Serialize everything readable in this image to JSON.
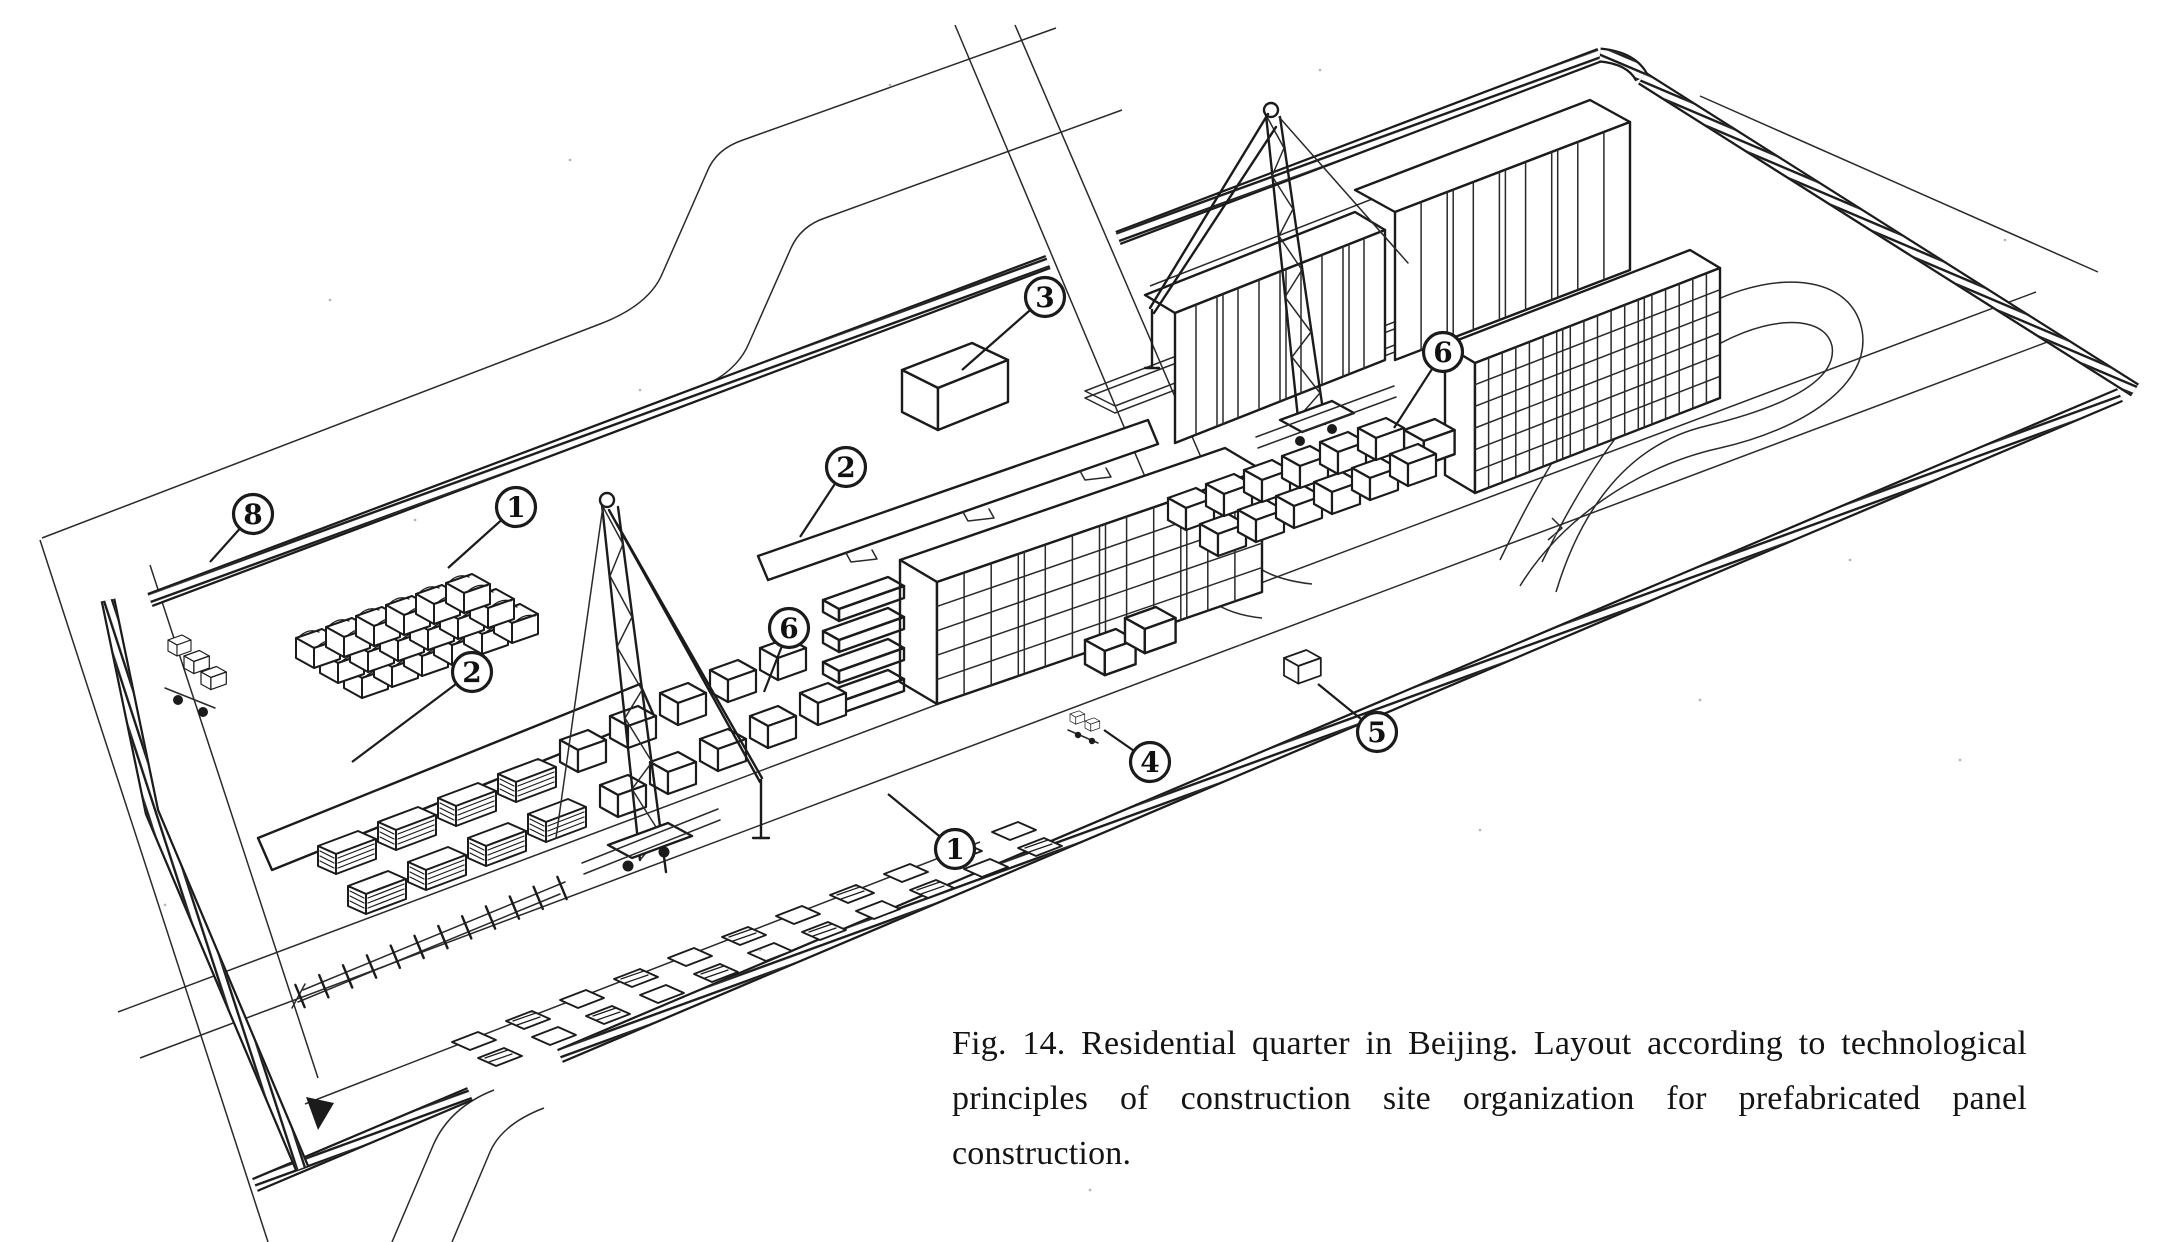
{
  "figure": {
    "caption": "Fig. 14. Residential quarter in Beijing. Layout according to technological principles of construction site organization for prefabricated panel construction.",
    "callouts": [
      {
        "label": "8",
        "cx": 253,
        "cy": 514,
        "lx": 210,
        "ly": 562
      },
      {
        "label": "1",
        "cx": 516,
        "cy": 507,
        "lx": 448,
        "ly": 568
      },
      {
        "label": "2",
        "cx": 472,
        "cy": 672,
        "lx": 352,
        "ly": 762
      },
      {
        "label": "6",
        "cx": 789,
        "cy": 628,
        "lx": 764,
        "ly": 692
      },
      {
        "label": "2",
        "cx": 846,
        "cy": 467,
        "lx": 800,
        "ly": 537
      },
      {
        "label": "3",
        "cx": 1045,
        "cy": 297,
        "lx": 962,
        "ly": 370
      },
      {
        "label": "6",
        "cx": 1443,
        "cy": 352,
        "lx": 1394,
        "ly": 428
      },
      {
        "label": "4",
        "cx": 1150,
        "cy": 762,
        "lx": 1104,
        "ly": 730
      },
      {
        "label": "5",
        "cx": 1377,
        "cy": 732,
        "lx": 1318,
        "ly": 684
      },
      {
        "label": "1",
        "cx": 955,
        "cy": 849,
        "lx": 888,
        "ly": 794
      }
    ]
  }
}
